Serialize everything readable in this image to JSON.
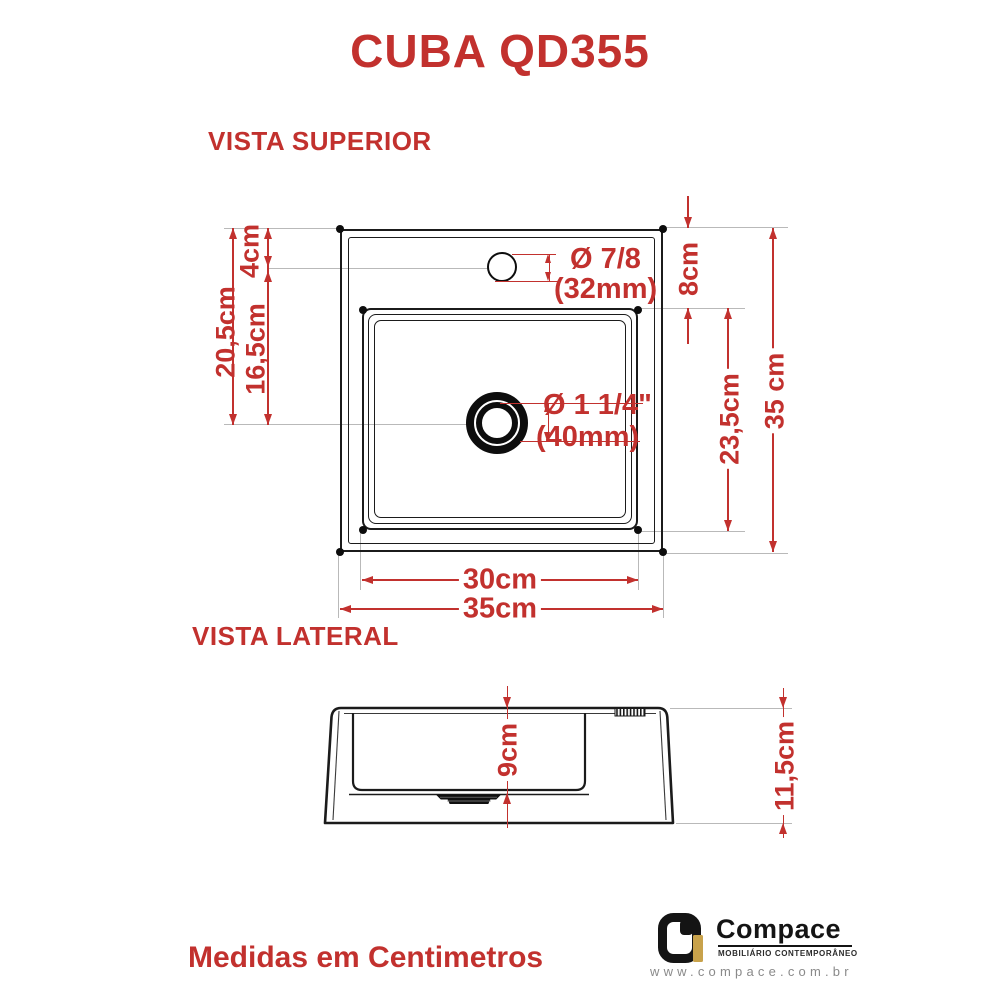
{
  "title": "CUBA QD355",
  "colors": {
    "accent_red": "#c2312e",
    "line_black": "#1b1b1b",
    "logo_gold": "#c8a24b"
  },
  "top_view": {
    "label": "VISTA SUPERIOR",
    "faucet_hole": {
      "dia_line1": "Ø 7/8",
      "dia_line2": "(32mm)"
    },
    "drain_hole": {
      "dia_line1": "Ø 1 1/4\"",
      "dia_line2": "(40mm)"
    },
    "dims": {
      "top_edge_to_faucet": "4cm",
      "top_edge_to_drain": "20,5cm",
      "faucet_to_drain": "16,5cm",
      "top_edge_to_basin": "8cm",
      "basin_length": "23,5cm",
      "overall_depth": "35 cm",
      "basin_width": "30cm",
      "overall_width": "35cm"
    }
  },
  "side_view": {
    "label": "VISTA LATERAL",
    "dims": {
      "basin_depth": "9cm",
      "overall_height": "11,5cm"
    }
  },
  "footer": {
    "note": "Medidas em Centimetros",
    "logo": {
      "brand": "Compace",
      "tagline": "MOBILIÁRIO CONTEMPORÂNEO",
      "url": "www.compace.com.br"
    }
  }
}
